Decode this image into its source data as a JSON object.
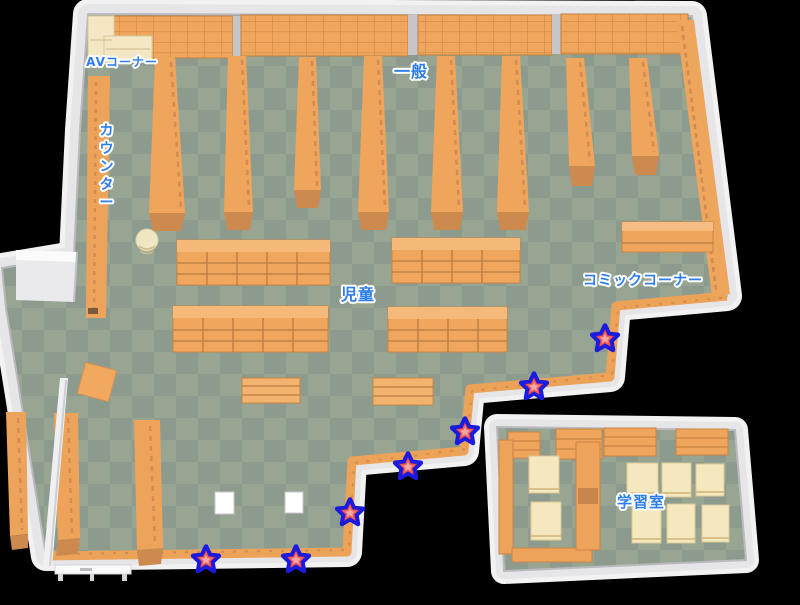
{
  "map": {
    "area_labels": {
      "av_corner": "AVコーナー",
      "general": "一般",
      "counter": "カウンター",
      "children": "児童",
      "comic_corner": "コミックコーナー",
      "study_room": "学習室"
    },
    "star_markers": [
      {
        "x": 605,
        "y": 339
      },
      {
        "x": 534,
        "y": 387
      },
      {
        "x": 465,
        "y": 432
      },
      {
        "x": 408,
        "y": 467
      },
      {
        "x": 350,
        "y": 513
      },
      {
        "x": 296,
        "y": 560
      },
      {
        "x": 206,
        "y": 560
      }
    ],
    "colors": {
      "label_blue": "#2d7df0",
      "floor_dark": "#8d9b8f",
      "floor_light": "#98a593",
      "shelf_orange": "#efa55c",
      "shelf_shadow": "#cd8a4f",
      "table_cream": "#f5e7bd",
      "wall_white": "#ececef",
      "star_ring_blue": "#1b1be0",
      "star_red": "#d63a4a"
    }
  }
}
